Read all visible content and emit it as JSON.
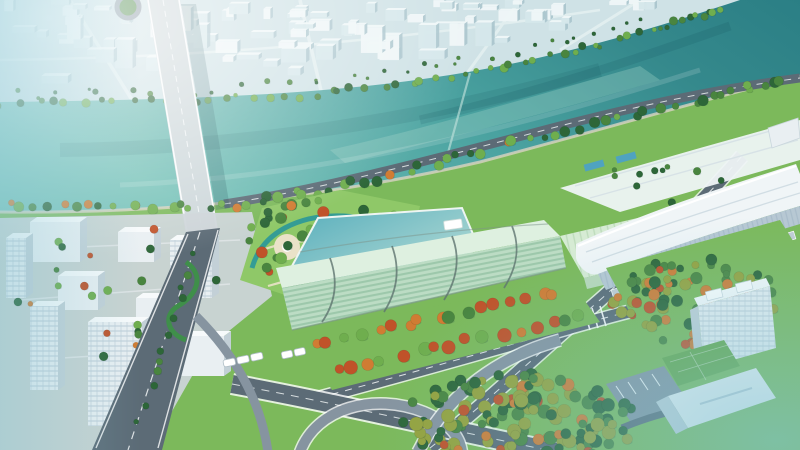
{
  "meta": {
    "description": "Aerial 3D architectural rendering of a riverfront urban development: teal river with road bridge, dense pale city on the far bank, landscaped park with winding canal, long mint-green louvered building, white curved-roof exhibition hall, highway interchange with toll gates, autumn tree rows, forests and a modern office tower with green roof",
    "width": 800,
    "height": 450
  },
  "palette": {
    "sky": "#d9ebed",
    "far_city_base": "#cfe2e6",
    "far_bldg_light": "#eef6f7",
    "far_bldg_mid": "#d5e7ea",
    "far_bldg_shadow": "#a9c4cc",
    "far_road": "#e3f0f1",
    "river_1": "#74c1b7",
    "river_2": "#4aa2a0",
    "river_3": "#35898c",
    "river_4": "#2b7f85",
    "shoal": "#9fd0c6",
    "weir": "#bfe0da",
    "bridge_deck": "#cdd7da",
    "lane": "#f4f7f8",
    "road": "#5c6b76",
    "road_light": "#8694a0",
    "grass": "#7cb95b",
    "lawn_light": "#8fc868",
    "park_path": "#eae2c8",
    "canal": "#2f9a98",
    "plaza": "#ccd4d8",
    "white_bldg": "#e9eff2",
    "white_bldg_side": "#c3d0d7",
    "white_bldg_top": "#f7fafb",
    "glass_line": "#9fb4c4",
    "gb_face": "#bcdcc4",
    "gb_stripe": "#8fbfa0",
    "gb_roof": "#def0e0",
    "gb_rib": "#5f7570",
    "gb_terrace": "#d6ebd4",
    "gb_terrace_line": "#aacfa8",
    "pond_1": "#57aebc",
    "pond_2": "#c6e4da",
    "hall_roof": "#f0f5f7",
    "hall_shade": "#cddae1",
    "hall_face": "#b7c8d3",
    "tower_green_roof": "#67a84b",
    "pool": "#4fa3c0",
    "tree_dark": "#2d6638",
    "tree_mid": "#49853f",
    "tree_light": "#6fae4e",
    "olive": "#95a23c",
    "orange": "#d07c33",
    "red": "#c05229",
    "hedge": "#3f8f4a",
    "haze_cyan": "#7fc4d4",
    "shadow": "#12444e"
  },
  "scene": {
    "regions": [
      {
        "id": "far-city-district",
        "label": "far bank city district"
      },
      {
        "id": "river",
        "label": "river"
      },
      {
        "id": "river-bridge",
        "label": "road bridge over river"
      },
      {
        "id": "business-district",
        "label": "near bank business district"
      },
      {
        "id": "riverside-park",
        "label": "landscaped park with canal"
      },
      {
        "id": "green-louvered-building",
        "label": "mint green louvered landmark building"
      },
      {
        "id": "exhibition-center",
        "label": "white curved-roof exhibition hall"
      },
      {
        "id": "highway-interchange",
        "label": "highway interchange with toll gates"
      },
      {
        "id": "office-tower",
        "label": "office tower with green roof"
      },
      {
        "id": "forests",
        "label": "mixed green and autumn forests"
      }
    ],
    "left_buildings": [
      {
        "x": 6,
        "y": 238,
        "w": 20,
        "h": 60,
        "win": true
      },
      {
        "x": 30,
        "y": 222,
        "w": 50,
        "h": 40,
        "win": false
      },
      {
        "x": 118,
        "y": 232,
        "w": 36,
        "h": 30,
        "win": false
      },
      {
        "x": 170,
        "y": 240,
        "w": 42,
        "h": 58,
        "win": true
      },
      {
        "x": 58,
        "y": 276,
        "w": 40,
        "h": 34,
        "win": false
      },
      {
        "x": 136,
        "y": 298,
        "w": 30,
        "h": 26,
        "win": false
      },
      {
        "x": 30,
        "y": 306,
        "w": 28,
        "h": 84,
        "win": true
      },
      {
        "x": 88,
        "y": 322,
        "w": 54,
        "h": 104,
        "win": true
      },
      {
        "x": 178,
        "y": 336,
        "w": 46,
        "h": 40,
        "win": false
      }
    ],
    "generators": [
      {
        "id": "far-city",
        "type": "city",
        "mount": "gen-far-city",
        "seed": 11,
        "count": 105,
        "xMax": 738,
        "margin": 14,
        "shore": [
          [
            0,
            100
          ],
          [
            300,
            95
          ],
          [
            430,
            76
          ],
          [
            560,
            50
          ],
          [
            680,
            18
          ],
          [
            738,
            0
          ]
        ]
      },
      {
        "id": "far-city-trees",
        "type": "tree-line",
        "mount": "gen-far-city-trees",
        "seed": 5,
        "count": 34,
        "r": [
          1.5,
          3
        ],
        "jitter": 6,
        "colors": [
          "tree_dark",
          "tree_mid"
        ],
        "accent": 0,
        "path": [
          [
            0,
            94
          ],
          [
            200,
            90
          ],
          [
            380,
            74
          ],
          [
            520,
            50
          ],
          [
            650,
            22
          ]
        ]
      },
      {
        "id": "far-shore-trees",
        "type": "tree-line",
        "mount": "gen-far-shore-trees",
        "seed": 7,
        "count": 58,
        "r": [
          2,
          4.5
        ],
        "jitter": 3,
        "colors": [
          "tree_dark",
          "tree_mid",
          "tree_light"
        ],
        "accent": 0.06,
        "path": [
          [
            0,
            103
          ],
          [
            150,
            101
          ],
          [
            300,
            96
          ],
          [
            430,
            80
          ],
          [
            550,
            57
          ],
          [
            660,
            29
          ],
          [
            724,
            8
          ]
        ]
      },
      {
        "id": "near-shore-trees",
        "type": "tree-line",
        "mount": "gen-near-shore-trees",
        "seed": 13,
        "count": 62,
        "r": [
          3,
          5.5
        ],
        "jitter": 4,
        "colors": [
          "tree_dark",
          "tree_mid",
          "tree_light"
        ],
        "accent": 0.12,
        "path": [
          [
            6,
            206
          ],
          [
            120,
            209
          ],
          [
            240,
            204
          ],
          [
            340,
            187
          ],
          [
            460,
            157
          ],
          [
            580,
            127
          ],
          [
            700,
            99
          ],
          [
            792,
            79
          ]
        ]
      },
      {
        "id": "district-trees",
        "type": "tree-blob",
        "mount": "gen-district-trees",
        "seed": 53,
        "count": 24,
        "r": [
          2.5,
          4.5
        ],
        "cx": 120,
        "cy": 300,
        "rx": 105,
        "ry": 75,
        "colors": [
          "tree_dark",
          "tree_mid",
          "tree_light"
        ],
        "accent": 0.12
      },
      {
        "id": "park-trees",
        "type": "tree-blob",
        "mount": "gen-park-trees",
        "seed": 21,
        "count": 48,
        "r": [
          3,
          6
        ],
        "cx": 330,
        "cy": 244,
        "rx": 88,
        "ry": 50,
        "colors": [
          "tree_dark",
          "tree_mid",
          "tree_light"
        ],
        "accent": 0.3
      },
      {
        "id": "roadside-trees",
        "type": "tree-line",
        "mount": "gen-roadside-trees",
        "seed": 51,
        "count": 12,
        "r": [
          2.5,
          4
        ],
        "jitter": 3,
        "colors": [
          "tree_dark",
          "tree_mid"
        ],
        "accent": 0.1,
        "path": [
          [
            196,
            252
          ],
          [
            166,
            340
          ],
          [
            138,
            428
          ]
        ]
      },
      {
        "id": "autumn-row-1",
        "type": "tree-line",
        "mount": "gen-autumn-rows",
        "seed": 31,
        "count": 17,
        "r": [
          4.5,
          6.5
        ],
        "jitter": 3,
        "colors": [
          "tree_mid",
          "tree_light"
        ],
        "accent": 0.7,
        "path": [
          [
            306,
            344
          ],
          [
            436,
            318
          ],
          [
            564,
            290
          ]
        ]
      },
      {
        "id": "autumn-row-2",
        "type": "tree-line",
        "mount": "gen-autumn-rows",
        "seed": 33,
        "count": 16,
        "r": [
          4.5,
          7
        ],
        "jitter": 3,
        "colors": [
          "tree_mid",
          "tree_light"
        ],
        "accent": 0.72,
        "path": [
          [
            330,
            370
          ],
          [
            460,
            342
          ],
          [
            588,
            316
          ]
        ]
      },
      {
        "id": "hall-plaza-trees",
        "type": "tree-blob",
        "mount": "gen-hall-trees",
        "seed": 57,
        "count": 10,
        "r": [
          2.5,
          4
        ],
        "cx": 665,
        "cy": 182,
        "rx": 66,
        "ry": 26,
        "colors": [
          "tree_dark",
          "tree_mid"
        ],
        "accent": 0.05
      },
      {
        "id": "right-forest",
        "type": "tree-blob",
        "mount": "gen-right-forest",
        "seed": 41,
        "count": 95,
        "r": [
          3.5,
          6
        ],
        "cx": 700,
        "cy": 302,
        "rx": 92,
        "ry": 44,
        "colors": [
          "tree_dark",
          "tree_mid",
          "olive"
        ],
        "accent": 0.4
      },
      {
        "id": "bottom-forest",
        "type": "tree-blob",
        "mount": "gen-bottom-forest",
        "seed": 43,
        "count": 150,
        "r": [
          4,
          7
        ],
        "cx": 520,
        "cy": 420,
        "rx": 118,
        "ry": 46,
        "colors": [
          "tree_dark",
          "tree_mid",
          "olive"
        ],
        "accent": 0.12
      }
    ]
  }
}
